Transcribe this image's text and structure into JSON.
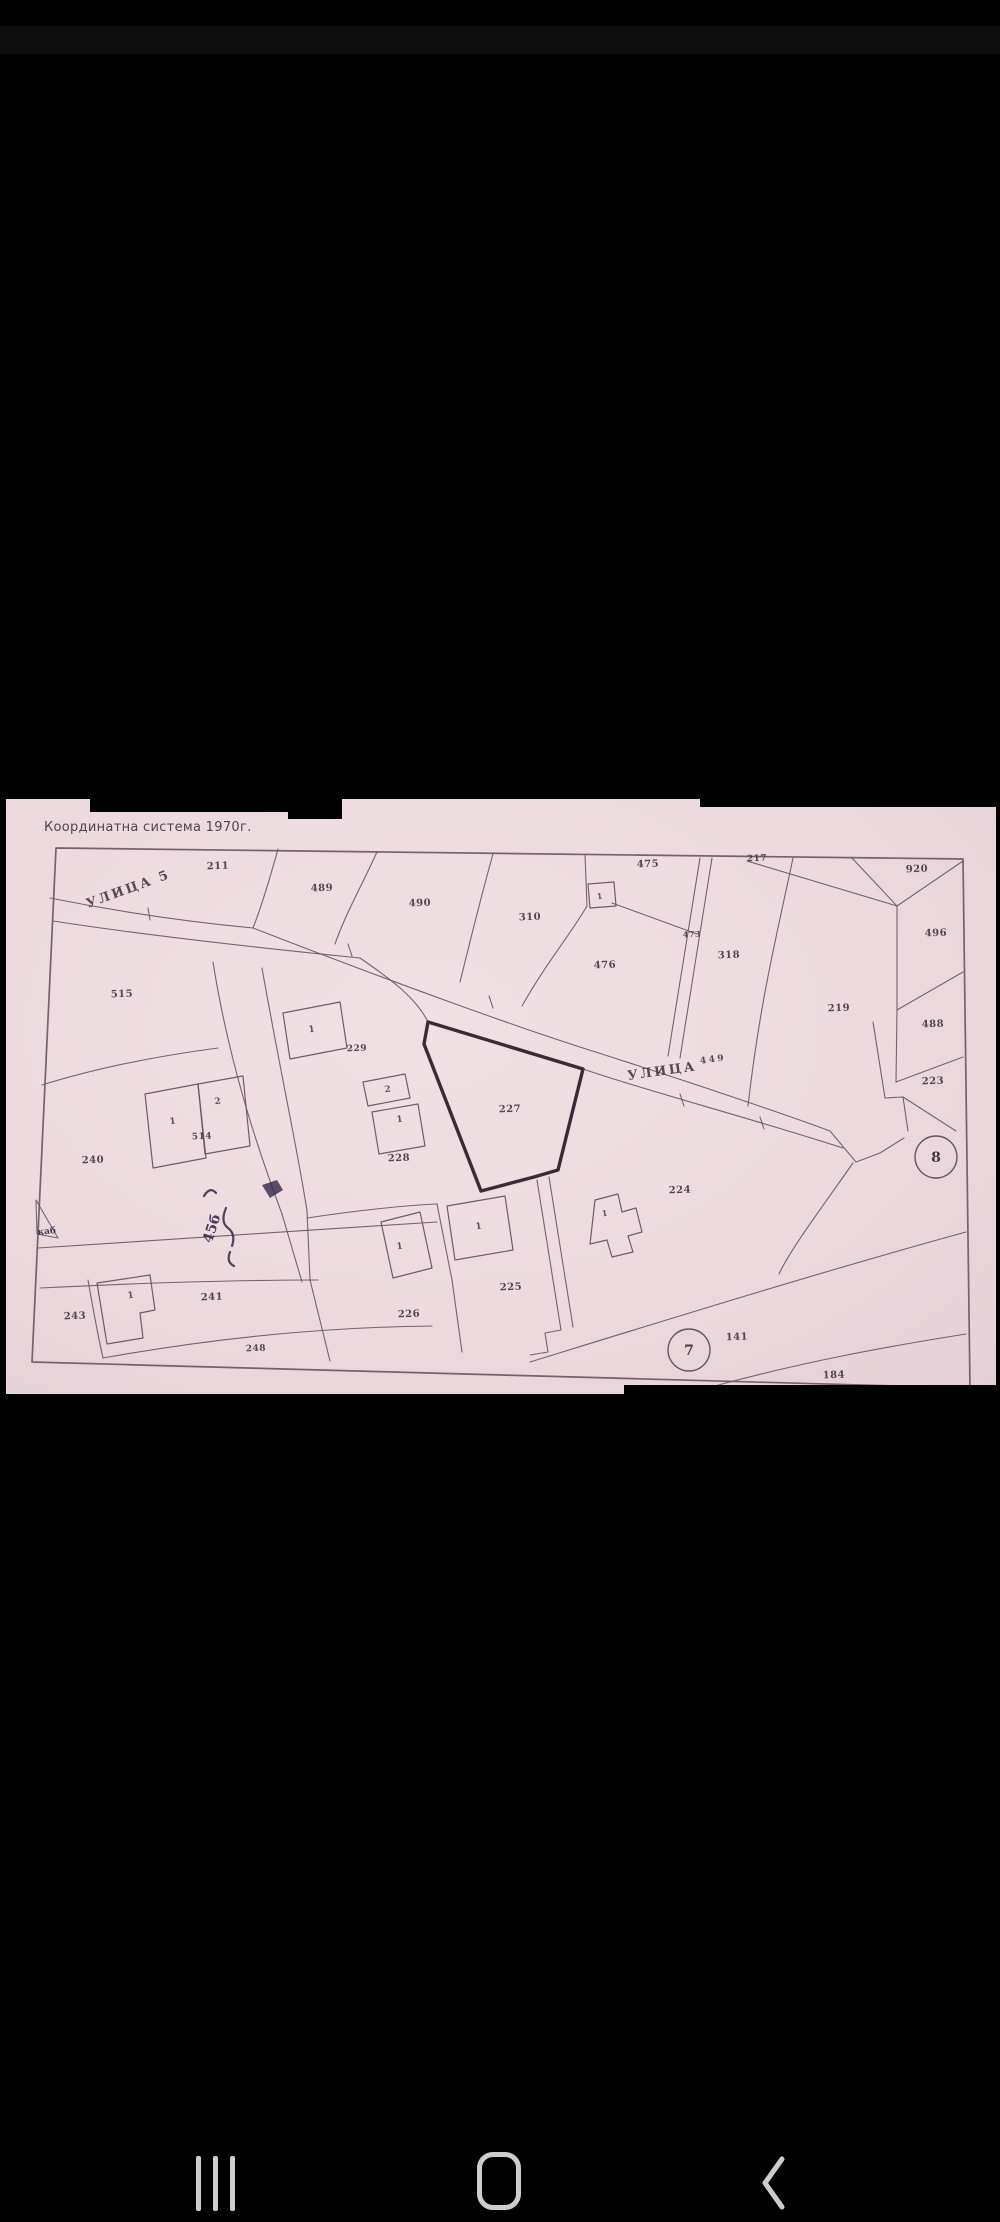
{
  "screen": {
    "background": "#000000"
  },
  "photo": {
    "caption": "Координатна система 1970г.",
    "paper_color": "#ecdade",
    "line_color": "#6b5360",
    "ink_color": "#35284a",
    "label_color": "#4a3743",
    "caption_color": "#56424e",
    "highlight_color": "#3c2b37"
  },
  "map": {
    "street_labels": [
      {
        "text": "УЛИЦА 5",
        "x": 88,
        "y": 908,
        "rot": -20,
        "size": 13
      },
      {
        "text": "УЛИЦА",
        "sup": "449",
        "x": 628,
        "y": 1080,
        "rot": -8,
        "size": 13
      }
    ],
    "parcel_labels": [
      {
        "text": "211",
        "x": 218,
        "y": 869
      },
      {
        "text": "489",
        "x": 322,
        "y": 891
      },
      {
        "text": "490",
        "x": 420,
        "y": 906
      },
      {
        "text": "310",
        "x": 530,
        "y": 920
      },
      {
        "text": "475",
        "x": 648,
        "y": 867
      },
      {
        "text": "476",
        "x": 605,
        "y": 968
      },
      {
        "text": "473",
        "x": 692,
        "y": 937,
        "size": 8
      },
      {
        "text": "217",
        "x": 757,
        "y": 861,
        "size": 9
      },
      {
        "text": "920",
        "x": 917,
        "y": 872
      },
      {
        "text": "496",
        "x": 936,
        "y": 936
      },
      {
        "text": "488",
        "x": 933,
        "y": 1027
      },
      {
        "text": "223",
        "x": 933,
        "y": 1084
      },
      {
        "text": "219",
        "x": 839,
        "y": 1011
      },
      {
        "text": "318",
        "x": 729,
        "y": 958
      },
      {
        "text": "515",
        "x": 122,
        "y": 997
      },
      {
        "text": "240",
        "x": 93,
        "y": 1163
      },
      {
        "text": "227",
        "x": 510,
        "y": 1112
      },
      {
        "text": "228",
        "x": 399,
        "y": 1161
      },
      {
        "text": "229",
        "x": 357,
        "y": 1051,
        "size": 9
      },
      {
        "text": "514",
        "x": 202,
        "y": 1139,
        "size": 9
      },
      {
        "text": "224",
        "x": 680,
        "y": 1193
      },
      {
        "text": "225",
        "x": 511,
        "y": 1290
      },
      {
        "text": "226",
        "x": 409,
        "y": 1317
      },
      {
        "text": "241",
        "x": 212,
        "y": 1300
      },
      {
        "text": "243",
        "x": 75,
        "y": 1319
      },
      {
        "text": "248",
        "x": 256,
        "y": 1351,
        "size": 9
      },
      {
        "text": "141",
        "x": 737,
        "y": 1340
      },
      {
        "text": "184",
        "x": 834,
        "y": 1378
      }
    ],
    "building_labels": [
      {
        "text": "1",
        "x": 600,
        "y": 899,
        "size": 8
      },
      {
        "text": "1",
        "x": 312,
        "y": 1032,
        "size": 9
      },
      {
        "text": "2",
        "x": 218,
        "y": 1104,
        "size": 9
      },
      {
        "text": "1",
        "x": 173,
        "y": 1124,
        "size": 9
      },
      {
        "text": "2",
        "x": 388,
        "y": 1092,
        "size": 9
      },
      {
        "text": "1",
        "x": 400,
        "y": 1122,
        "size": 9
      },
      {
        "text": "1",
        "x": 479,
        "y": 1229,
        "size": 9
      },
      {
        "text": "1",
        "x": 400,
        "y": 1249,
        "size": 9
      },
      {
        "text": "1",
        "x": 131,
        "y": 1298,
        "size": 9
      },
      {
        "text": "1",
        "x": 605,
        "y": 1216,
        "size": 8
      }
    ],
    "circle_labels": [
      {
        "text": "8",
        "cx": 936,
        "cy": 1157,
        "r": 21
      },
      {
        "text": "7",
        "cx": 689,
        "cy": 1350,
        "r": 21
      }
    ],
    "annotations": [
      {
        "text": "45б",
        "x": 216,
        "y": 1230,
        "rot": -72,
        "size": 14
      },
      {
        "text": "каб",
        "x": 47,
        "y": 1234,
        "rot": -6,
        "size": 9
      }
    ]
  },
  "nav_bar": {
    "icon_color": "#cdcdcd",
    "recents_icon": "recents",
    "home_icon": "home",
    "back_icon": "back"
  }
}
